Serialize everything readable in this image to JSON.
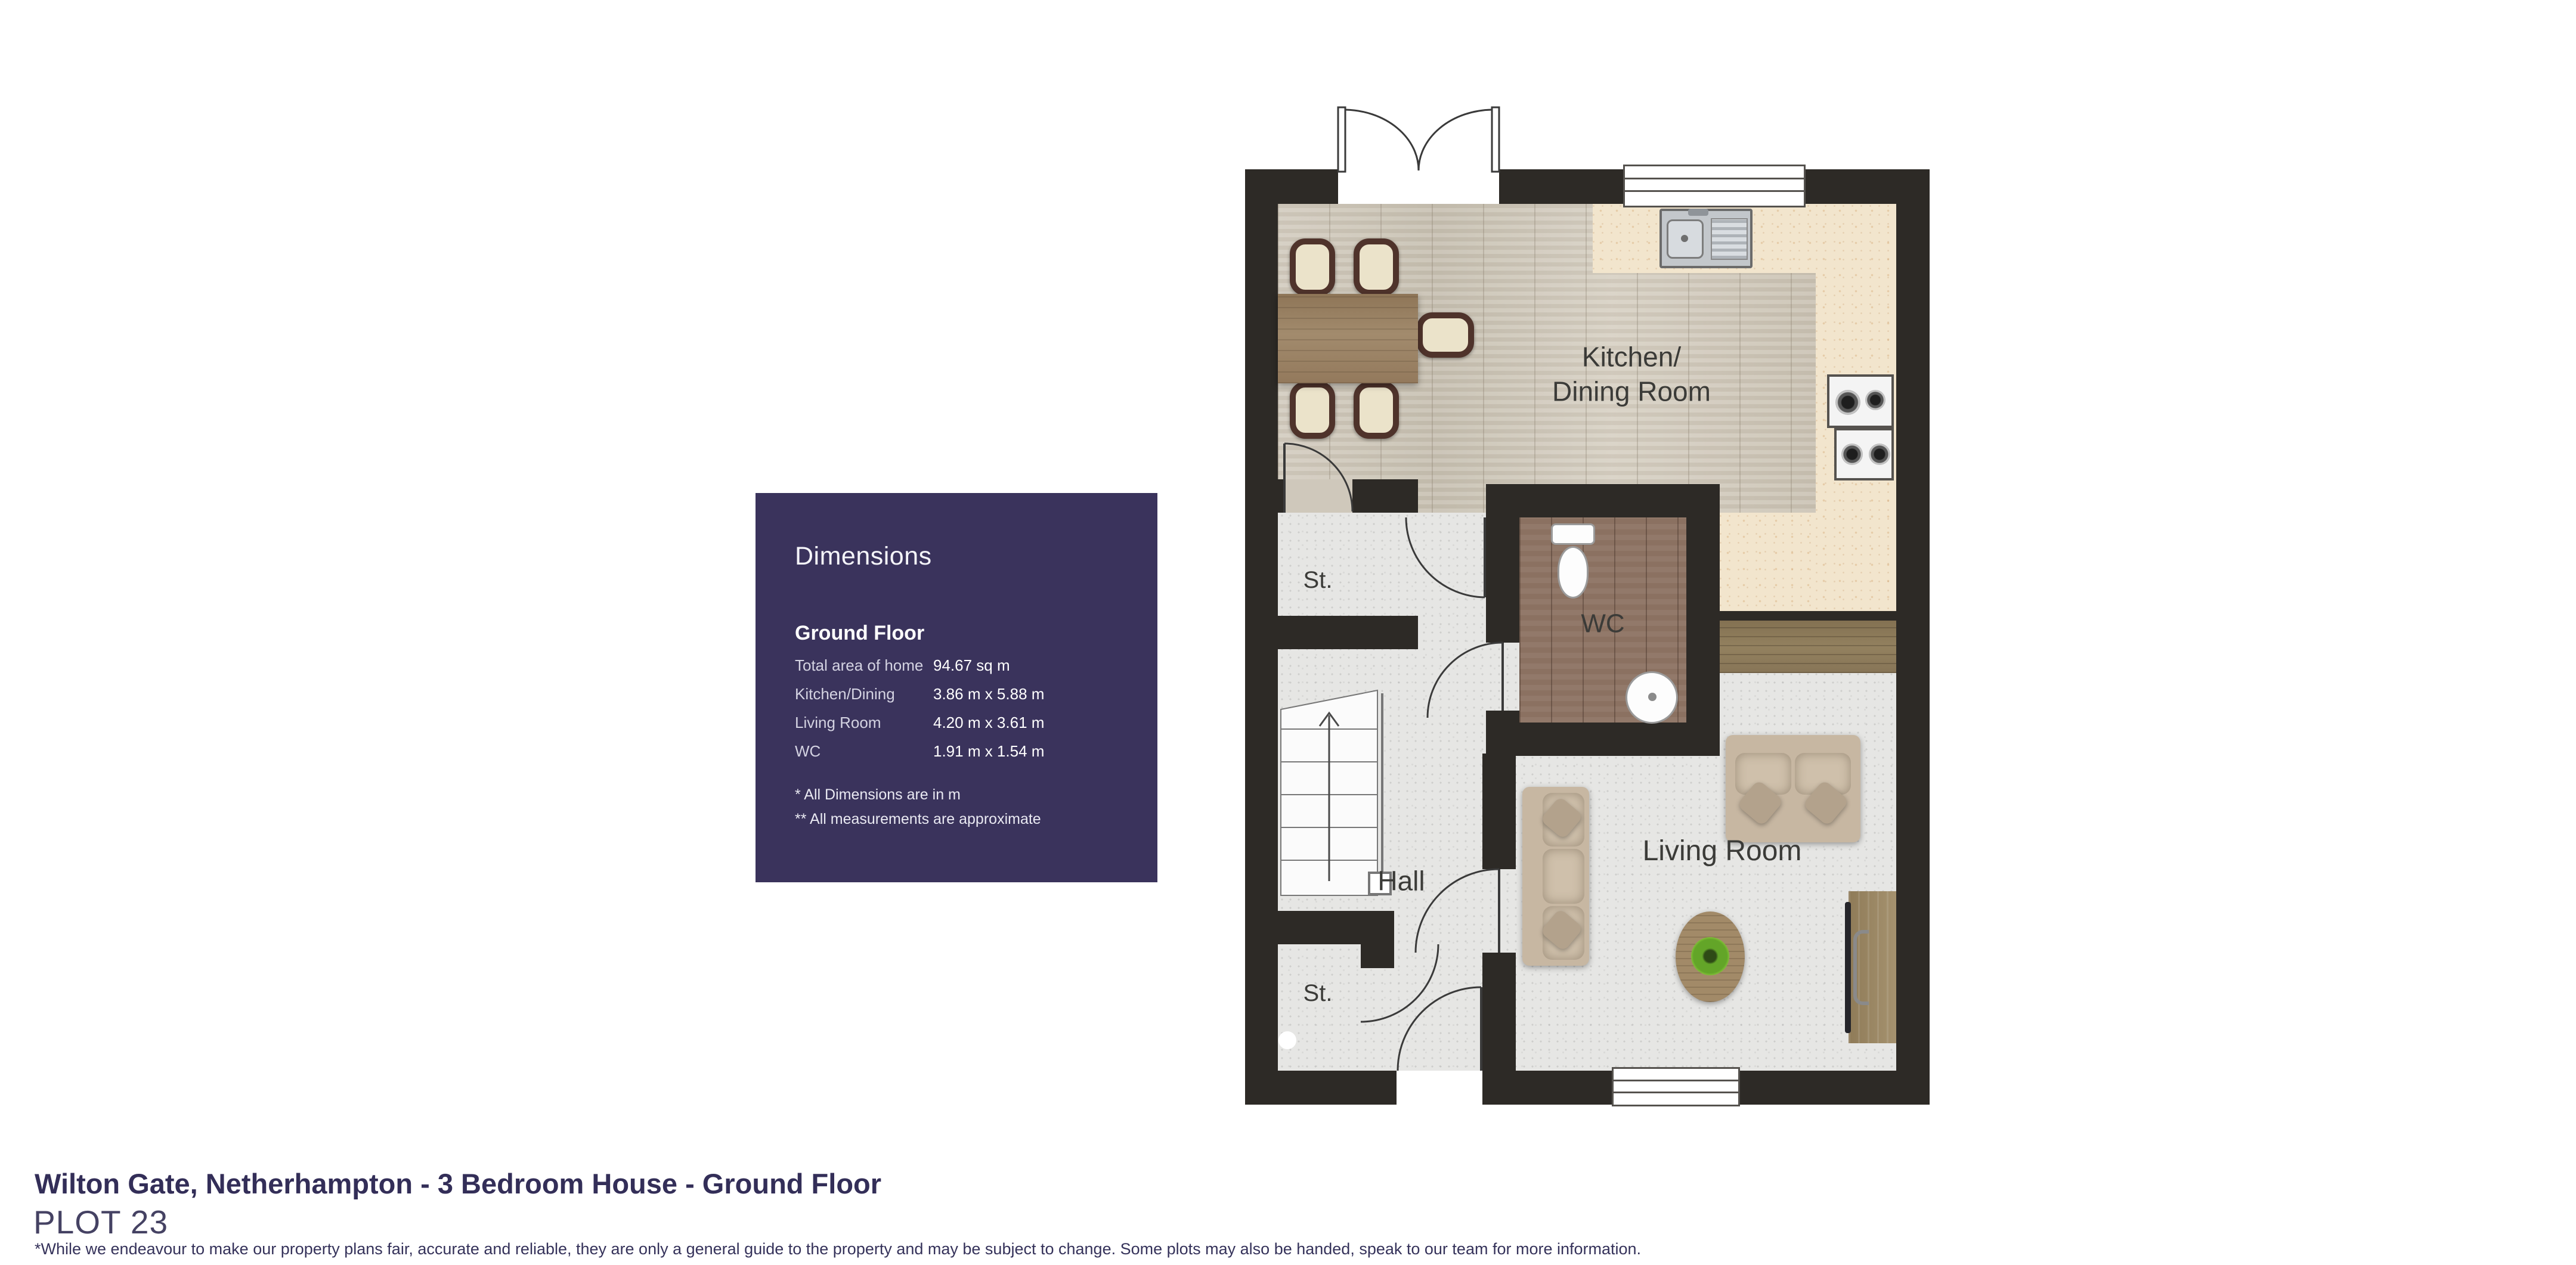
{
  "dimensions_panel": {
    "background": "#3a335c",
    "title": "Dimensions",
    "section_title": "Ground Floor",
    "rows": [
      {
        "label": "Total area of home",
        "value": "94.67 sq m"
      },
      {
        "label": "Kitchen/Dining",
        "value": "3.86 m x 5.88 m"
      },
      {
        "label": "Living Room",
        "value": "4.20 m x 3.61 m"
      },
      {
        "label": "WC",
        "value": "1.91 m x 1.54 m"
      }
    ],
    "footnotes": [
      "* All Dimensions are in m",
      "** All measurements are approximate"
    ]
  },
  "floor_plan": {
    "rooms": {
      "kitchen_dining_line1": "Kitchen/",
      "kitchen_dining_line2": "Dining Room",
      "wc": "WC",
      "hall": "Hall",
      "living_room": "Living Room",
      "storage_top": "St.",
      "storage_bottom": "St."
    },
    "colors": {
      "wall": "#2d2a26",
      "carpet": "#e6e6e4",
      "kitchen_wood": "#cfc8bb",
      "counter": "#f2e5cd",
      "wc_wood": "#8b7161",
      "worktop": "#8b795c"
    }
  },
  "footer": {
    "title": "Wilton Gate, Netherhampton - 3 Bedroom House - Ground Floor",
    "plot": "PLOT 23",
    "disclaimer": "*While we endeavour to make our property plans fair, accurate and reliable, they are only a general guide to the property and may be subject to change. Some plots may also be handed, speak to our team for more information."
  }
}
